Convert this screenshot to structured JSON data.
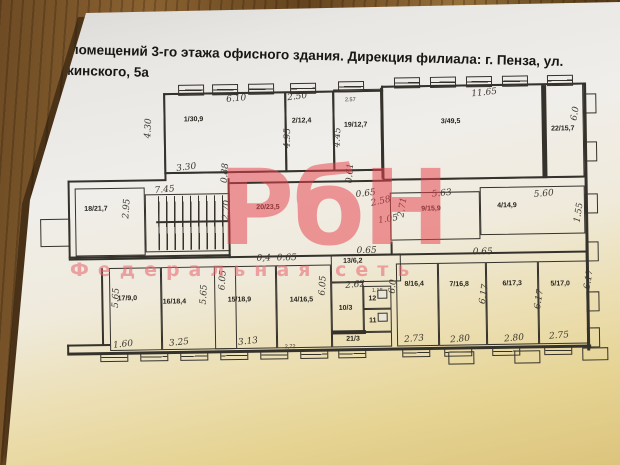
{
  "title": {
    "line1": "План помещений 3-го этажа офисного здания. Дирекция филиала: г. Пенза, ул.",
    "line2": "Дзержинского, 5а"
  },
  "watermark": {
    "logo": "РбН",
    "subtitle": "Федеральная сеть"
  },
  "plan": {
    "rooms": [
      {
        "id": "r1",
        "label": "1/30,9"
      },
      {
        "id": "r2",
        "label": "2/12,4"
      },
      {
        "id": "r19",
        "label": "19/12,7"
      },
      {
        "id": "r3",
        "label": "3/49,5"
      },
      {
        "id": "r22",
        "label": "22/15,7"
      },
      {
        "id": "r18",
        "label": "18/21,7"
      },
      {
        "id": "r20",
        "label": "20/23,5"
      },
      {
        "id": "r9",
        "label": "9/15,9"
      },
      {
        "id": "r4",
        "label": "4/14,9"
      },
      {
        "id": "r17",
        "label": "17/9,0"
      },
      {
        "id": "r16",
        "label": "16/18,4"
      },
      {
        "id": "r15",
        "label": "15/18,9"
      },
      {
        "id": "r14",
        "label": "14/16,5"
      },
      {
        "id": "r13",
        "label": "13/6,2"
      },
      {
        "id": "r10",
        "label": "10/3"
      },
      {
        "id": "r12",
        "label": "12"
      },
      {
        "id": "r11",
        "label": "11"
      },
      {
        "id": "r21",
        "label": "21/3"
      },
      {
        "id": "r8",
        "label": "8/16,4"
      },
      {
        "id": "r7",
        "label": "7/16,8"
      },
      {
        "id": "r6",
        "label": "6/17,3"
      },
      {
        "id": "r5",
        "label": "5/17,0"
      }
    ],
    "dims": [
      {
        "id": "d1",
        "text": "6.10"
      },
      {
        "id": "d2",
        "text": "4.30"
      },
      {
        "id": "d3",
        "text": "3.30"
      },
      {
        "id": "d4",
        "text": "2.50"
      },
      {
        "id": "d5",
        "text": "2.57"
      },
      {
        "id": "d6",
        "text": "4.95"
      },
      {
        "id": "d7",
        "text": "4.45"
      },
      {
        "id": "d8",
        "text": "11.65"
      },
      {
        "id": "d9",
        "text": "6.0"
      },
      {
        "id": "d10",
        "text": "7.45"
      },
      {
        "id": "d11",
        "text": "2.95"
      },
      {
        "id": "d12",
        "text": "0.88"
      },
      {
        "id": "d13",
        "text": "2.70"
      },
      {
        "id": "d14",
        "text": "0.65"
      },
      {
        "id": "d15",
        "text": "2.58"
      },
      {
        "id": "d16",
        "text": "2.71"
      },
      {
        "id": "d17",
        "text": "1.05"
      },
      {
        "id": "d18",
        "text": "5.63"
      },
      {
        "id": "d19",
        "text": "5.60"
      },
      {
        "id": "d20",
        "text": "1.55"
      },
      {
        "id": "d21",
        "text": "0,4"
      },
      {
        "id": "d22",
        "text": "0.65"
      },
      {
        "id": "d23",
        "text": "0.65"
      },
      {
        "id": "d24",
        "text": "0.65"
      },
      {
        "id": "d25",
        "text": "1.60"
      },
      {
        "id": "d26",
        "text": "3.25"
      },
      {
        "id": "d27",
        "text": "3.13"
      },
      {
        "id": "d28",
        "text": "2,72"
      },
      {
        "id": "d29",
        "text": "2.62"
      },
      {
        "id": "d30",
        "text": "1.18"
      },
      {
        "id": "d31",
        "text": "2.73"
      },
      {
        "id": "d32",
        "text": "2.80"
      },
      {
        "id": "d33",
        "text": "2.80"
      },
      {
        "id": "d34",
        "text": "2.75"
      },
      {
        "id": "d35",
        "text": "5.65"
      },
      {
        "id": "d36",
        "text": "5.65"
      },
      {
        "id": "d37",
        "text": "6.05"
      },
      {
        "id": "d38",
        "text": "6.05"
      },
      {
        "id": "d39",
        "text": "6.0"
      },
      {
        "id": "d40",
        "text": "6.17"
      },
      {
        "id": "d41",
        "text": "6.17"
      },
      {
        "id": "d42",
        "text": "6.17"
      },
      {
        "id": "d43",
        "text": "0.61"
      }
    ]
  },
  "colors": {
    "ink": "#35322c",
    "watermark_red": "#e8434e",
    "paper_yellow": "#dcc47c",
    "wood_brown": "#6e4b24"
  }
}
